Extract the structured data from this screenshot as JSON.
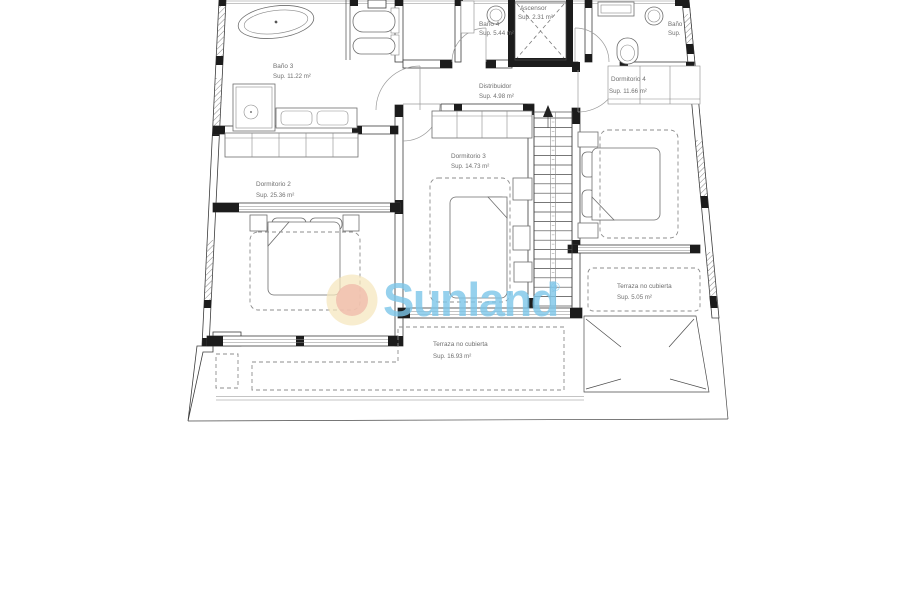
{
  "watermark": {
    "brand": "Sunland",
    "registered": "®",
    "colors": {
      "text_blue": "#7cc5e9",
      "sun_outer": "#f5e6bd",
      "sun_inner": "#f0bcab"
    }
  },
  "rooms": [
    {
      "id": "bano3",
      "name": "Baño 3",
      "area": "Sup. 11.22 m²"
    },
    {
      "id": "bano4",
      "name": "Baño 4",
      "area": "Sup. 5.44 m²"
    },
    {
      "id": "ascensor",
      "name": "Ascensor",
      "area": "Sup. 2.31 m²"
    },
    {
      "id": "distribuidor",
      "name": "Distribuidor",
      "area": "Sup. 4.98 m²"
    },
    {
      "id": "dormitorio4",
      "name": "Dormitorio 4",
      "area": "Sup. 11.66 m²"
    },
    {
      "id": "dormitorio3",
      "name": "Dormitorio 3",
      "area": "Sup. 14.73 m²"
    },
    {
      "id": "dormitorio2",
      "name": "Dormitorio 2",
      "area": "Sup. 25.36 m²"
    },
    {
      "id": "terraza_5",
      "name": "Terraza no cubierta",
      "area": "Sup. 5.05 m²"
    },
    {
      "id": "terraza_16",
      "name": "Terraza no cubierta",
      "area": "Sup. 16.93 m²"
    },
    {
      "id": "bano_clipped",
      "name": "Baño",
      "area": "Sup."
    }
  ]
}
